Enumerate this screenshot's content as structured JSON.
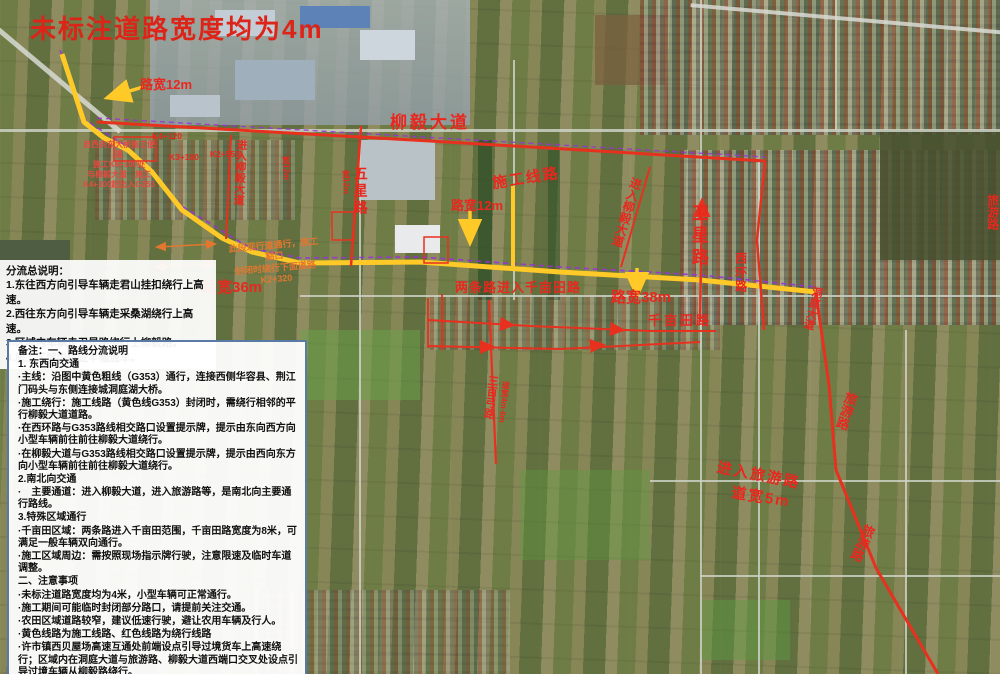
{
  "map_labels": {
    "title": "未标注道路宽度均为4m",
    "lukuan12": "路宽12m",
    "lukuan36": "路宽36m",
    "lukuan38": "路宽38m",
    "kuan12": "宽12m",
    "liuyi_dadao": "柳毅大道",
    "shigong_xianlu": "施工线路",
    "weixing_lu": "卫星路",
    "wuxing_lu": "五星路",
    "xihuan_lu": "西环路",
    "dongting_dadao": "洞庭大道",
    "jinru_liuyi": "进入柳毅大道",
    "liangtiaolu": "两条路进入千亩田路",
    "qianmutian_lu": "千亩田路",
    "lvyou_lu": "旅游路",
    "jinru_lvyou": "进入旅游路",
    "daokuan5": "道宽5m",
    "sanbaigong_lu": "三百弓路",
    "daokuan46": "道宽4m-6m",
    "k4_120": "K4+120",
    "k3_100": "K3+100",
    "k2_550": "K2+550",
    "nw_note_1": "自西向东大桥施工便道",
    "nw_note_2": "施工K4+100处",
    "nw_note_3": "与柳毅大道　施工",
    "nw_note_4": "K4+100起出入G353",
    "orange_note_1": "此段现行道通行，施工豁口",
    "orange_note_2": "封闭时绕行下面道路",
    "orange_note_3": "K2+320"
  },
  "panel": {
    "summary": [
      "分流总说明：",
      "1.东往西方向引导车辆走君山挂扣绕行上高速。",
      "2.西往东方向引导车辆走采桑湖绕行上高速。",
      "3.区域内车辆走卫星路绕行上柳毅路。",
      "4.施工区域内保证半幅通车。"
    ],
    "notes": [
      "备注：一、路线分流说明",
      "1. 东西向交通",
      "·主线：沿图中黄色粗线（G353）通行，连接西侧华容县、荆江门码头与东侧连接城洞庭湖大桥。",
      "·施工绕行：施工线路（黄色线G353）封闭时，需绕行相邻的平行柳毅大道道路。",
      "·在西环路与G353路线相交路口设置提示牌，提示由东向西方向小型车辆前往前往柳毅大道绕行。",
      "·在柳毅大道与G353路线相交路口设置提示牌，提示由西向东方向小型车辆前往前往柳毅大道绕行。",
      "2.南北向交通",
      "·　主要通道：进入柳毅大道，进入旅游路等，是南北向主要通行路线。",
      "3.特殊区域通行",
      "·千亩田区域：两条路进入千亩田范围，千亩田路宽度为8米，可满足一般车辆双向通行。",
      "·施工区域周边：需按照现场指示牌行驶，注意限速及临时车道调整。",
      "二、注意事项",
      "·未标注道路宽度均为4米，小型车辆可正常通行。",
      "·施工期间可能临时封闭部分路口，请提前关注交通。",
      "·农田区域道路较窄，建议低速行驶，避让农用车辆及行人。",
      "·黄色线路为施工线路、红色线路为绕行线路",
      "·许市镇西贝屋场高速互通处前端设点引导过境货车上高速绕行；区域内在洞庭大道与旅游路、柳毅大道西端口交叉处设点引导过境车辆从柳毅路绕行。"
    ]
  },
  "colors": {
    "construction_route_yellow": "#ffc928",
    "detour_route_red": "#e8301f",
    "annotation_red": "#e8281e",
    "annotation_orange": "#e2772f",
    "survey_dash_purple": "#9b30d9"
  }
}
